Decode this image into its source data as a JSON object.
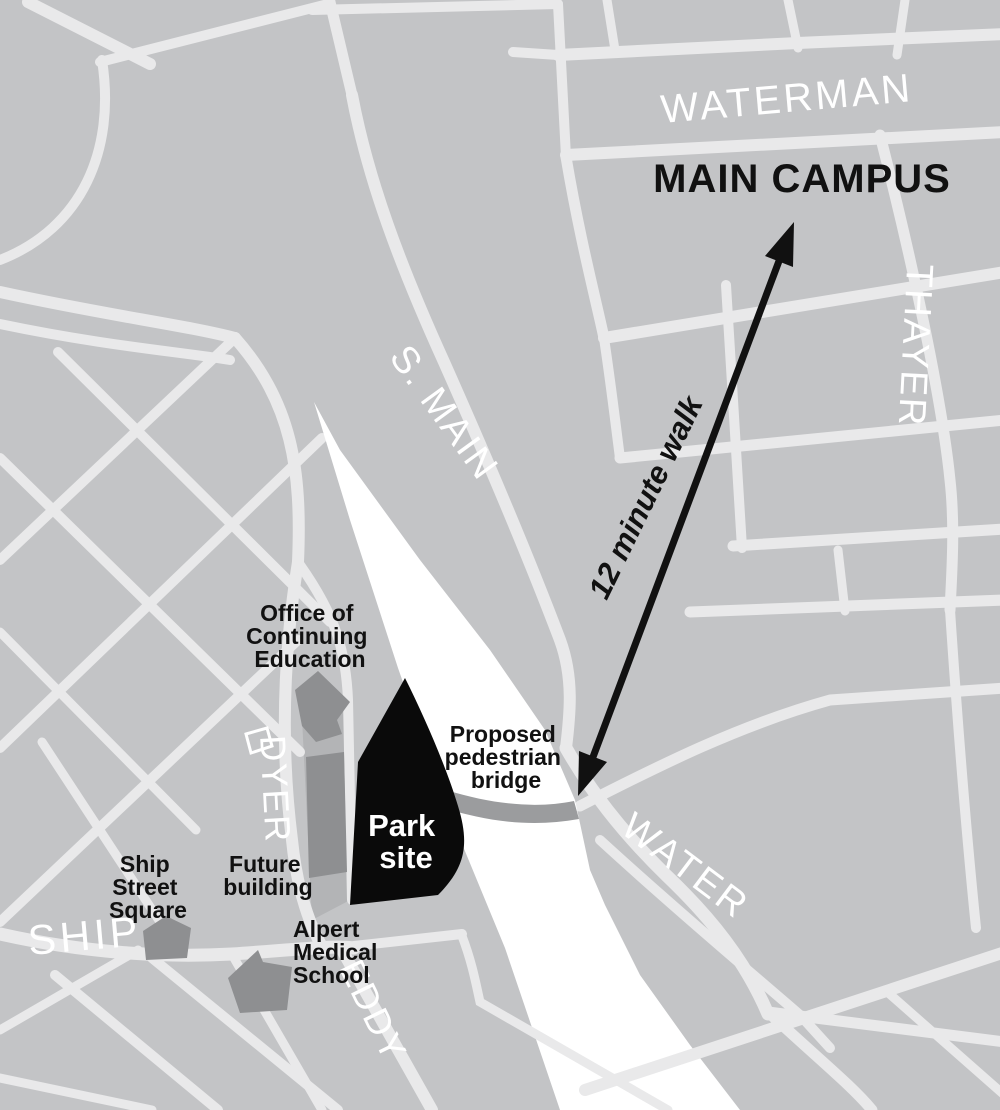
{
  "map": {
    "region_labels": {
      "main_campus": "MAIN CAMPUS",
      "walk_note": "12 minute walk"
    },
    "street_labels": {
      "waterman": "WATERMAN",
      "thayer": "THAYER",
      "s_main": "S. MAIN",
      "water": "WATER",
      "ship": "SHIP",
      "dyer": "DYER",
      "eddy": "EDDY"
    },
    "places": {
      "office": {
        "line1": "Office of",
        "line2": "Continuing",
        "line3": "Education"
      },
      "future_building": {
        "line1": "Future",
        "line2": "building"
      },
      "park_site": {
        "line1": "Park",
        "line2": "site"
      },
      "proposed_bridge": {
        "line1": "Proposed",
        "line2": "pedestrian",
        "line3": "bridge"
      },
      "ship_street_square": {
        "line1": "Ship",
        "line2": "Street",
        "line3": "Square"
      },
      "alpert": {
        "line1": "Alpert",
        "line2": "Medical",
        "line3": "School"
      }
    },
    "colors": {
      "background": "#c3c4c6",
      "street": "#e9e9ea",
      "river": "#ffffff",
      "building": "#8e8f91",
      "block_shade": "#b3b4b6",
      "bridge": "#9b9c9e",
      "park": "#0a0a0a",
      "label_dark": "#111111",
      "label_light": "#ffffff"
    }
  }
}
